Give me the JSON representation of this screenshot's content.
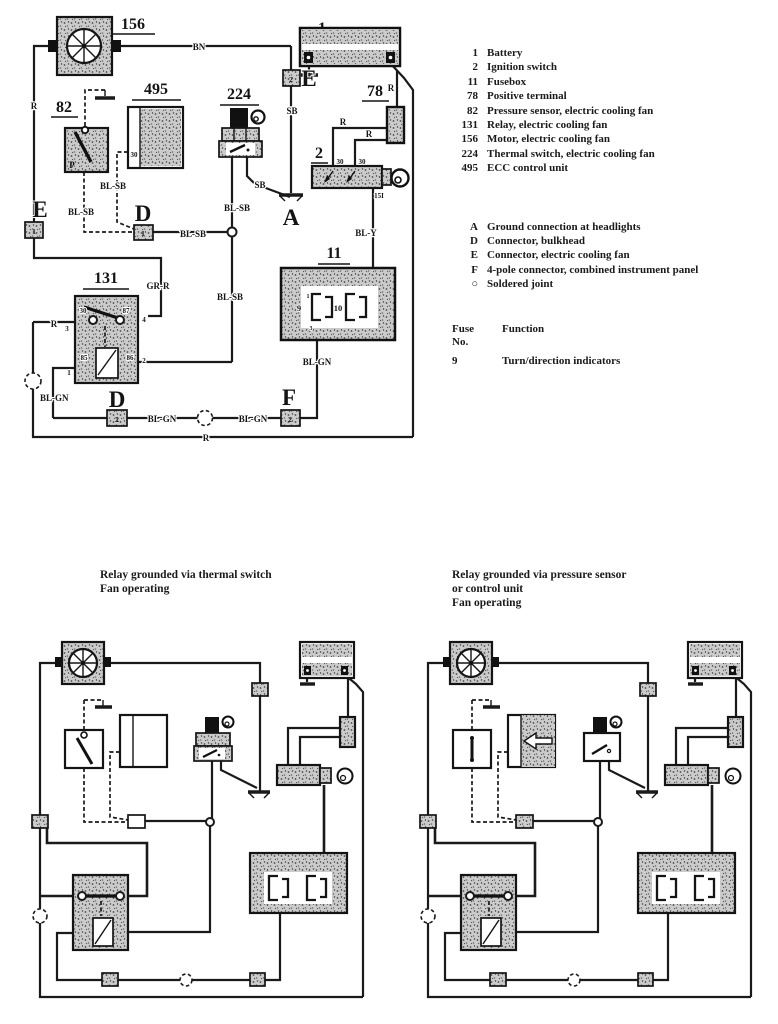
{
  "legend": {
    "components": [
      {
        "num": "1",
        "label": "Battery"
      },
      {
        "num": "2",
        "label": "Ignition switch"
      },
      {
        "num": "11",
        "label": "Fusebox"
      },
      {
        "num": "78",
        "label": "Positive terminal"
      },
      {
        "num": "82",
        "label": "Pressure sensor, electric cooling fan"
      },
      {
        "num": "131",
        "label": "Relay, electric cooling fan"
      },
      {
        "num": "156",
        "label": "Motor, electric cooling fan"
      },
      {
        "num": "224",
        "label": "Thermal switch, electric cooling fan"
      },
      {
        "num": "495",
        "label": "ECC control unit"
      }
    ],
    "symbols": [
      {
        "key": "A",
        "label": "Ground connection at headlights"
      },
      {
        "key": "D",
        "label": "Connector, bulkhead"
      },
      {
        "key": "E",
        "label": "Connector, electric cooling fan"
      },
      {
        "key": "F",
        "label": "4-pole connector, combined instrument panel"
      },
      {
        "key": "○",
        "label": "Soldered joint"
      }
    ],
    "fuse_table": {
      "header_col1": "Fuse",
      "header_col1_line2": "No.",
      "header_col2": "Function",
      "rows": [
        {
          "no": "9",
          "function": "Turn/direction indicators"
        }
      ]
    }
  },
  "captions": {
    "left_line1": "Relay grounded via thermal switch",
    "left_line2": "Fan operating",
    "right_line1": "Relay grounded via pressure sensor",
    "right_line2": "or control unit",
    "right_line3": "Fan operating"
  },
  "diagram": {
    "ids": {
      "battery": "1",
      "ignition": "2",
      "fusebox": "11",
      "positive_terminal": "78",
      "pressure_sensor": "82",
      "relay": "131",
      "motor": "156",
      "thermal_switch": "224",
      "ecc": "495"
    },
    "letters": {
      "a": "A",
      "d": "D",
      "e": "E",
      "f": "F"
    },
    "pins": {
      "p1": "1",
      "p2": "2"
    },
    "wires": {
      "bn": "BN",
      "r": "R",
      "sb": "SB",
      "bl_sb": "BL-SB",
      "gr_r": "GR-R",
      "bl_y": "BL-Y",
      "bl_gn": "BL-GN"
    },
    "terminals": {
      "t30": "30",
      "t15i": "15I",
      "t87": "87",
      "t85": "85",
      "t86": "86",
      "t1": "1",
      "t2": "2",
      "t3": "3",
      "t4": "4",
      "p": "P",
      "fuse9": "9",
      "fuse10": "10"
    }
  }
}
